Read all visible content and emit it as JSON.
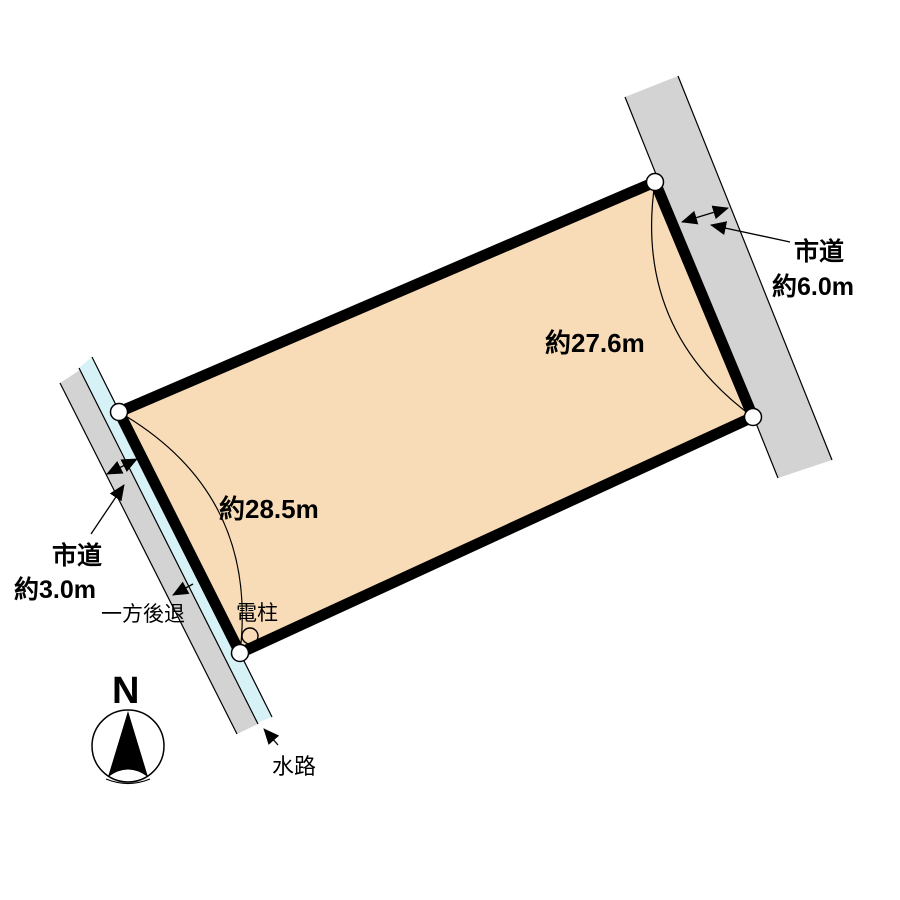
{
  "title": "土地区画図 (land plot diagram)",
  "colors": {
    "parcel_fill": "#F8DCB8",
    "road_fill": "#D3D3D3",
    "waterway_fill": "#D6F2F6",
    "line": "#000000",
    "vertex_fill": "#FFFFFF"
  },
  "labels": {
    "dimension_east": "約27.6m",
    "dimension_west": "約28.5m",
    "road_ne_name": "市道",
    "road_ne_width": "約6.0m",
    "road_sw_name": "市道",
    "road_sw_width": "約3.0m",
    "setback": "一方後退",
    "utility_pole": "電柱",
    "waterway": "水路",
    "compass_north": "N"
  }
}
